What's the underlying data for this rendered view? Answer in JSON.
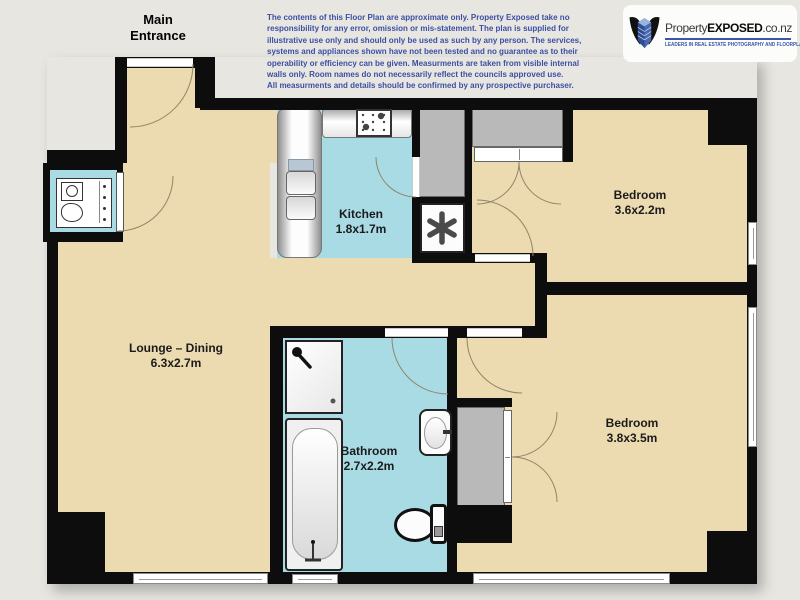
{
  "title": "Apartment floor plan",
  "colors": {
    "background": "#e8e6e1",
    "wall": "#0d0d0d",
    "floor_dry": "#ecdbb0",
    "floor_wet": "#a9dbe5",
    "wardrobe_gray": "#b9b9b9",
    "arc_line": "#8f8569",
    "disclaimer_text": "#3c4fa3",
    "logo_accent": "#3a57a7"
  },
  "annotations": {
    "main_entrance": "Main Entrance"
  },
  "disclaimer": {
    "text": "The contents of this Floor Plan are approximate only.  Property Exposed take no\nresponsibility for any error, omission or mis-statement.  The plan is supplied for\nillustrative use only and should only be used as such by any person.  The services,\nsystems and appliances shown have not been tested and no guarantee as to their\noperability or efficiency can be given.  Measurments are taken from visible internal\nwalls only.  Room names do not necessarily reflect the councils approved use.\nAll measurments and details should be confirmed by any prospective purchaser."
  },
  "logo": {
    "brand_regular": "Property",
    "brand_bold": "EXPOSED",
    "brand_suffix": ".co.nz",
    "tagline": "LEADERS IN REAL ESTATE PHOTOGRAPHY AND FLOORPLANS"
  },
  "rooms": [
    {
      "id": "kitchen",
      "name": "Kitchen",
      "dims": "1.8x1.7m"
    },
    {
      "id": "lounge-dining",
      "name": "Lounge – Dining",
      "dims": "6.3x2.7m"
    },
    {
      "id": "bathroom",
      "name": "Bathroom",
      "dims": "2.7x2.2m"
    },
    {
      "id": "bedroom-1",
      "name": "Bedroom",
      "dims": "3.6x2.2m"
    },
    {
      "id": "bedroom-2",
      "name": "Bedroom",
      "dims": "3.8x3.5m"
    }
  ],
  "icons": {
    "hot_water_cylinder": "asterisk-star",
    "cooktop": "four-burner-hob",
    "kitchen_sink": "double-basin",
    "shower": "shower-head",
    "bath": "bathtub",
    "basin": "hand-basin",
    "toilet": "toilet-with-cistern",
    "laundry": "washing-machine-and-tub",
    "logo_mark": "winged-building"
  }
}
